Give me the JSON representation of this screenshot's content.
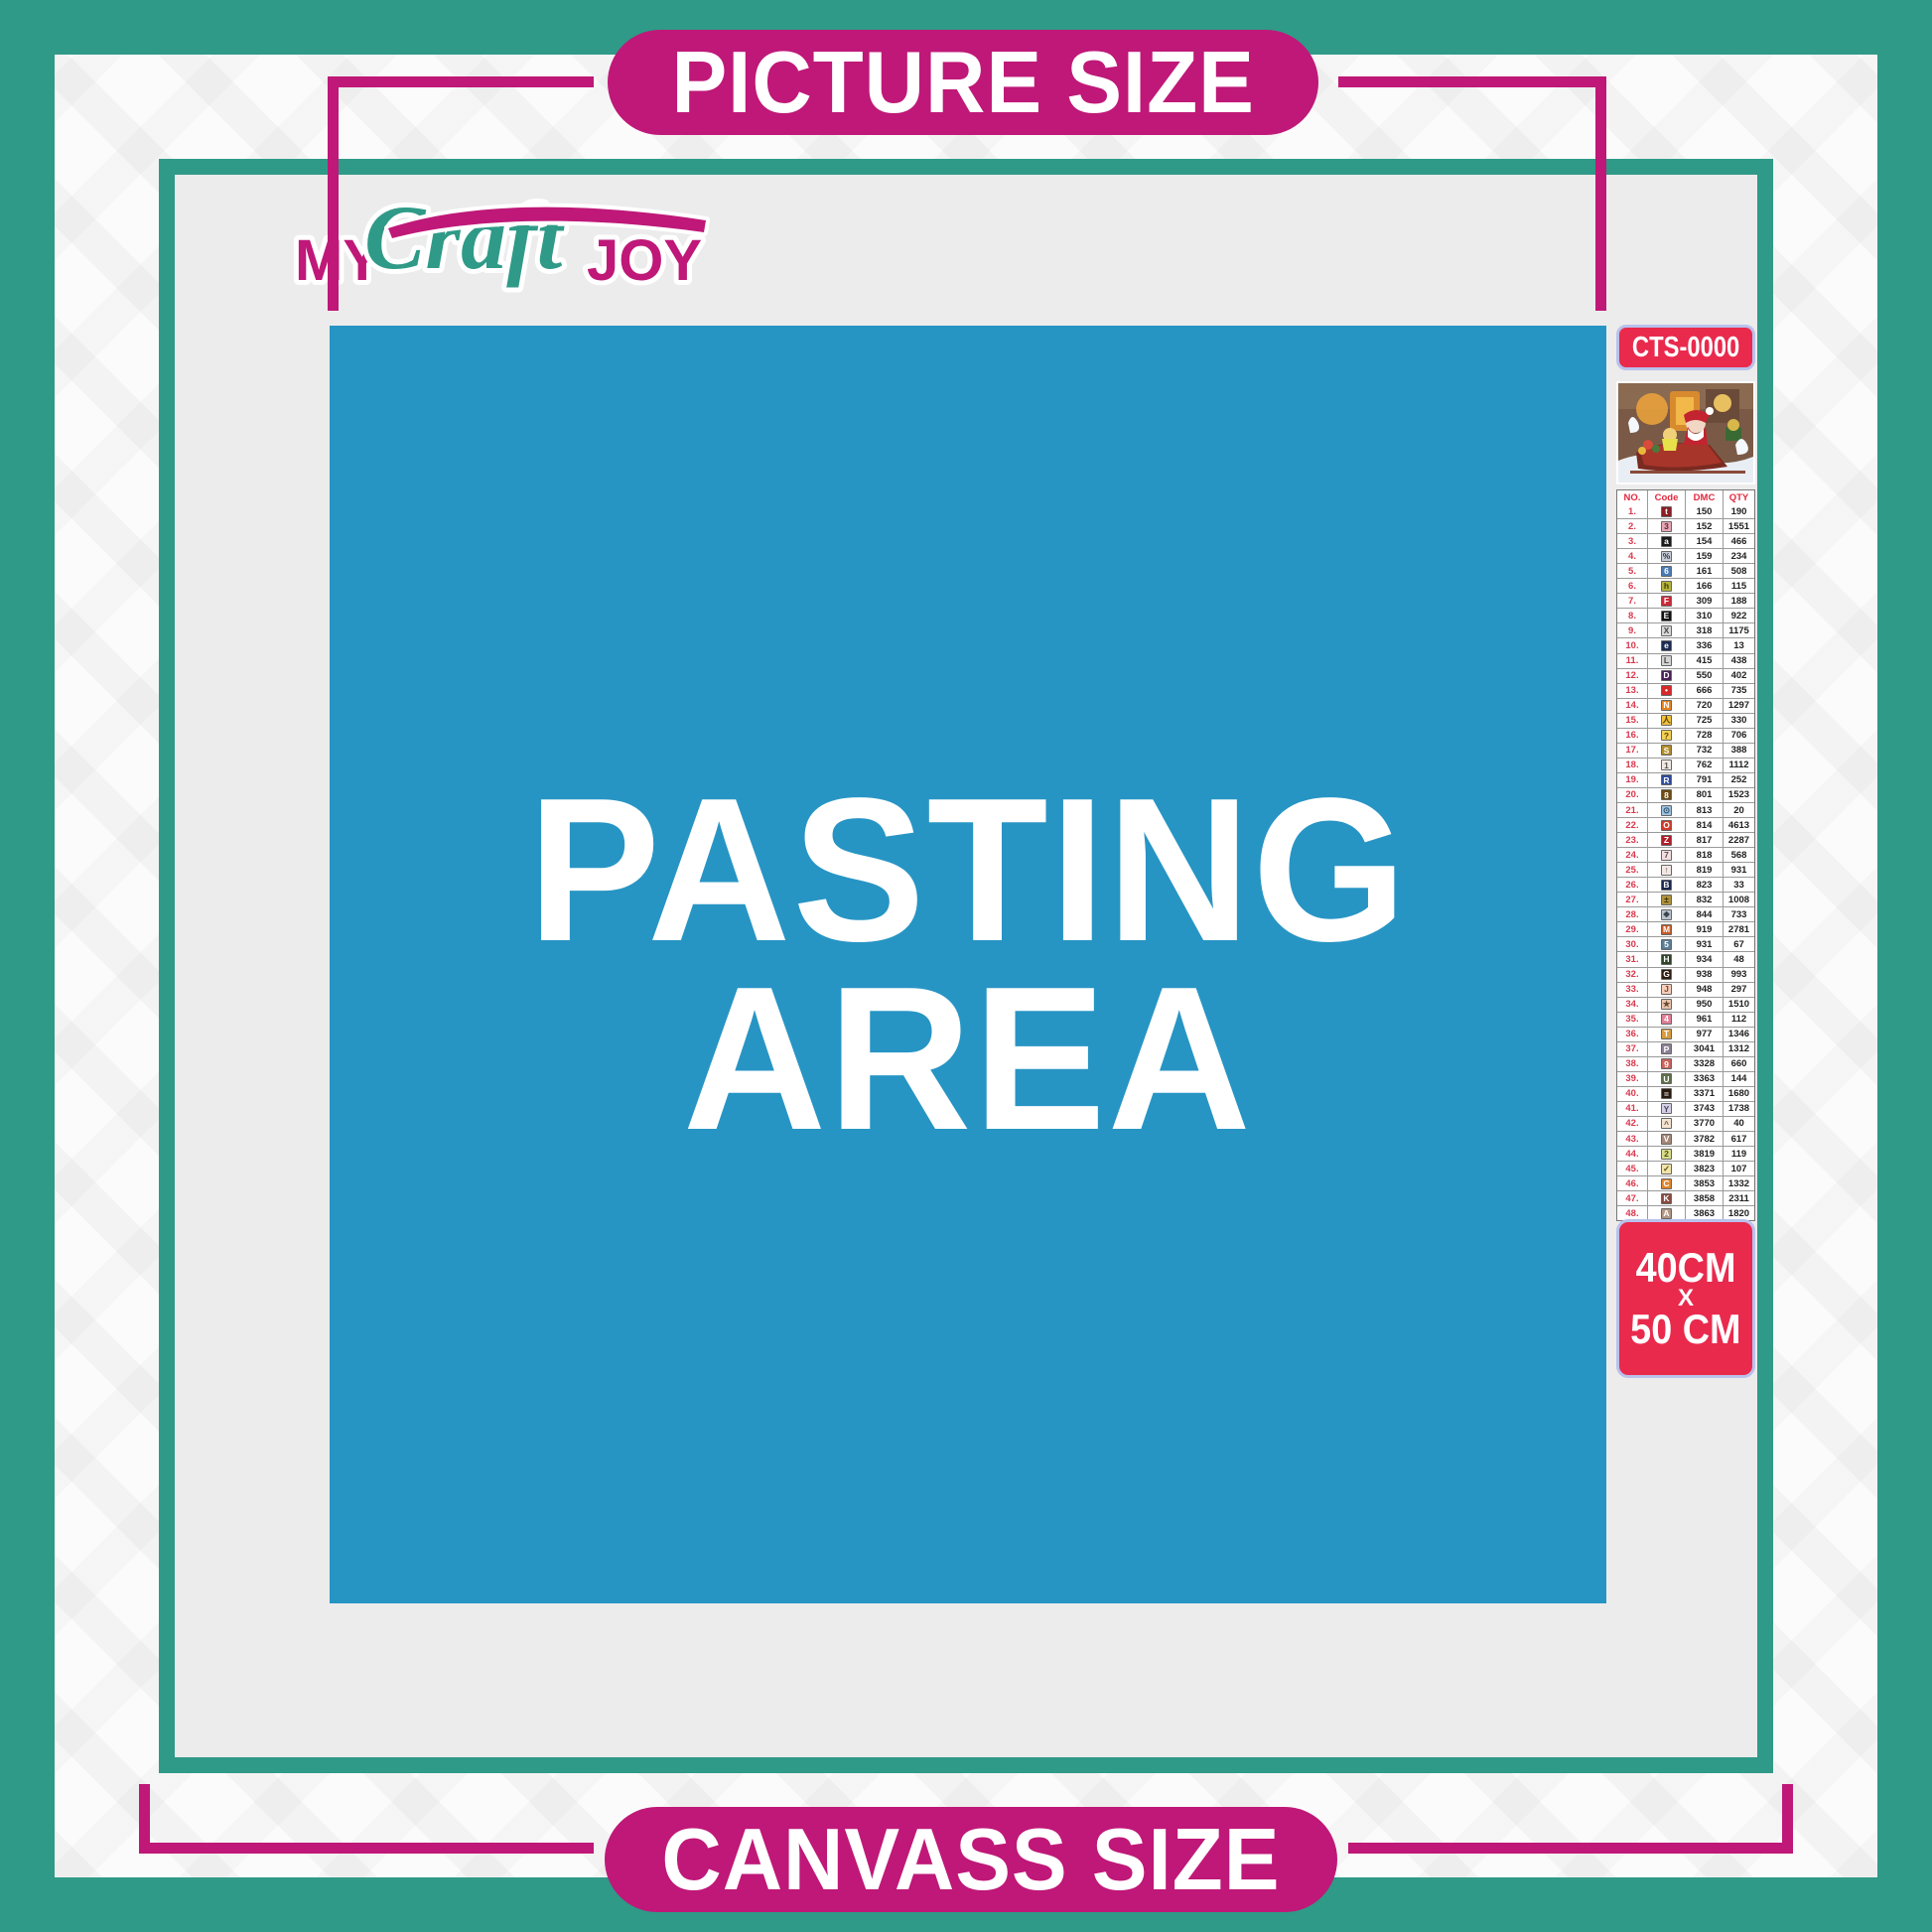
{
  "brand": {
    "my": "MY",
    "craft": "Craft",
    "joy": "JOY"
  },
  "banners": {
    "top": "PICTURE SIZE",
    "bottom": "CANVASS SIZE"
  },
  "pasting_area": {
    "line1": "PASTING",
    "line2": "AREA"
  },
  "sidebar": {
    "sku": "CTS-0000",
    "preview_alt": "santa-sleigh-christmas-scene",
    "size": {
      "line1": "40CM",
      "line2": "X",
      "line3": "50 CM"
    },
    "table": {
      "headers": [
        "NO.",
        "Code",
        "DMC",
        "QTY"
      ],
      "rows": [
        {
          "no": "1.",
          "sym": "t",
          "bg": "#8b1f24",
          "fg": "#ffffff",
          "dmc": "150",
          "qty": "190"
        },
        {
          "no": "2.",
          "sym": "3",
          "bg": "#e8a7b4",
          "fg": "#5a2a33",
          "dmc": "152",
          "qty": "1551"
        },
        {
          "no": "3.",
          "sym": "a",
          "bg": "#1a1a1a",
          "fg": "#ffffff",
          "dmc": "154",
          "qty": "466"
        },
        {
          "no": "4.",
          "sym": "%",
          "bg": "#c5cdd8",
          "fg": "#333333",
          "dmc": "159",
          "qty": "234"
        },
        {
          "no": "5.",
          "sym": "6",
          "bg": "#4a7ab5",
          "fg": "#ffffff",
          "dmc": "161",
          "qty": "508"
        },
        {
          "no": "6.",
          "sym": "h",
          "bg": "#b5b23a",
          "fg": "#3a3a10",
          "dmc": "166",
          "qty": "115"
        },
        {
          "no": "7.",
          "sym": "F",
          "bg": "#c92a39",
          "fg": "#ffffff",
          "dmc": "309",
          "qty": "188"
        },
        {
          "no": "8.",
          "sym": "E",
          "bg": "#111111",
          "fg": "#ffffff",
          "dmc": "310",
          "qty": "922"
        },
        {
          "no": "9.",
          "sym": "X",
          "bg": "#d8d8d8",
          "fg": "#444444",
          "dmc": "318",
          "qty": "1175"
        },
        {
          "no": "10.",
          "sym": "e",
          "bg": "#1d2c52",
          "fg": "#ffffff",
          "dmc": "336",
          "qty": "13"
        },
        {
          "no": "11.",
          "sym": "L",
          "bg": "#d3d3d3",
          "fg": "#444444",
          "dmc": "415",
          "qty": "438"
        },
        {
          "no": "12.",
          "sym": "D",
          "bg": "#4a2057",
          "fg": "#ffffff",
          "dmc": "550",
          "qty": "402"
        },
        {
          "no": "13.",
          "sym": "•",
          "bg": "#d62828",
          "fg": "#ffffff",
          "dmc": "666",
          "qty": "735"
        },
        {
          "no": "14.",
          "sym": "N",
          "bg": "#e8861f",
          "fg": "#ffffff",
          "dmc": "720",
          "qty": "1297"
        },
        {
          "no": "15.",
          "sym": "人",
          "bg": "#f0c03c",
          "fg": "#5a4208",
          "dmc": "725",
          "qty": "330"
        },
        {
          "no": "16.",
          "sym": "?",
          "bg": "#f3cf53",
          "fg": "#5a4208",
          "dmc": "728",
          "qty": "706"
        },
        {
          "no": "17.",
          "sym": "S",
          "bg": "#b08c28",
          "fg": "#ffffff",
          "dmc": "732",
          "qty": "388"
        },
        {
          "no": "18.",
          "sym": "1",
          "bg": "#f3e9e2",
          "fg": "#555555",
          "dmc": "762",
          "qty": "1112"
        },
        {
          "no": "19.",
          "sym": "R",
          "bg": "#2d4b9b",
          "fg": "#ffffff",
          "dmc": "791",
          "qty": "252"
        },
        {
          "no": "20.",
          "sym": "8",
          "bg": "#6b4a12",
          "fg": "#ffffff",
          "dmc": "801",
          "qty": "1523"
        },
        {
          "no": "21.",
          "sym": "⊙",
          "bg": "#9cc3e0",
          "fg": "#2a4a66",
          "dmc": "813",
          "qty": "20"
        },
        {
          "no": "22.",
          "sym": "O",
          "bg": "#cf3a2a",
          "fg": "#ffffff",
          "dmc": "814",
          "qty": "4613"
        },
        {
          "no": "23.",
          "sym": "Z",
          "bg": "#b01e28",
          "fg": "#ffffff",
          "dmc": "817",
          "qty": "2287"
        },
        {
          "no": "24.",
          "sym": "7",
          "bg": "#f6dde0",
          "fg": "#555555",
          "dmc": "818",
          "qty": "568"
        },
        {
          "no": "25.",
          "sym": "↑",
          "bg": "#f4e8e4",
          "fg": "#555555",
          "dmc": "819",
          "qty": "931"
        },
        {
          "no": "26.",
          "sym": "B",
          "bg": "#17264d",
          "fg": "#ffffff",
          "dmc": "823",
          "qty": "33"
        },
        {
          "no": "27.",
          "sym": "±",
          "bg": "#ad913c",
          "fg": "#3a2e08",
          "dmc": "832",
          "qty": "1008"
        },
        {
          "no": "28.",
          "sym": "❖",
          "bg": "#b9c3cc",
          "fg": "#3a444e",
          "dmc": "844",
          "qty": "733"
        },
        {
          "no": "29.",
          "sym": "M",
          "bg": "#c35a28",
          "fg": "#ffffff",
          "dmc": "919",
          "qty": "2781"
        },
        {
          "no": "30.",
          "sym": "5",
          "bg": "#5b7e96",
          "fg": "#ffffff",
          "dmc": "931",
          "qty": "67"
        },
        {
          "no": "31.",
          "sym": "H",
          "bg": "#2f4428",
          "fg": "#ffffff",
          "dmc": "934",
          "qty": "48"
        },
        {
          "no": "32.",
          "sym": "G",
          "bg": "#2e1d12",
          "fg": "#ffffff",
          "dmc": "938",
          "qty": "993"
        },
        {
          "no": "33.",
          "sym": "J",
          "bg": "#f5cdb8",
          "fg": "#7a4a30",
          "dmc": "948",
          "qty": "297"
        },
        {
          "no": "34.",
          "sym": "★",
          "bg": "#e7c3ac",
          "fg": "#6a4a34",
          "dmc": "950",
          "qty": "1510"
        },
        {
          "no": "35.",
          "sym": "4",
          "bg": "#e07f96",
          "fg": "#ffffff",
          "dmc": "961",
          "qty": "112"
        },
        {
          "no": "36.",
          "sym": "T",
          "bg": "#d89b3f",
          "fg": "#ffffff",
          "dmc": "977",
          "qty": "1346"
        },
        {
          "no": "37.",
          "sym": "P",
          "bg": "#8d8096",
          "fg": "#ffffff",
          "dmc": "3041",
          "qty": "1312"
        },
        {
          "no": "38.",
          "sym": "9",
          "bg": "#c9645c",
          "fg": "#ffffff",
          "dmc": "3328",
          "qty": "660"
        },
        {
          "no": "39.",
          "sym": "U",
          "bg": "#5e7049",
          "fg": "#ffffff",
          "dmc": "3363",
          "qty": "144"
        },
        {
          "no": "40.",
          "sym": "=",
          "bg": "#2a1b10",
          "fg": "#ffffff",
          "dmc": "3371",
          "qty": "1680"
        },
        {
          "no": "41.",
          "sym": "Y",
          "bg": "#d5cee4",
          "fg": "#4a4460",
          "dmc": "3743",
          "qty": "1738"
        },
        {
          "no": "42.",
          "sym": "^",
          "bg": "#f4e3cf",
          "fg": "#6a5a44",
          "dmc": "3770",
          "qty": "40"
        },
        {
          "no": "43.",
          "sym": "V",
          "bg": "#a48778",
          "fg": "#ffffff",
          "dmc": "3782",
          "qty": "617"
        },
        {
          "no": "44.",
          "sym": "2",
          "bg": "#d9dc8a",
          "fg": "#4a4e10",
          "dmc": "3819",
          "qty": "119"
        },
        {
          "no": "45.",
          "sym": "✓",
          "bg": "#f2e3a7",
          "fg": "#5a5020",
          "dmc": "3823",
          "qty": "107"
        },
        {
          "no": "46.",
          "sym": "C",
          "bg": "#e0862e",
          "fg": "#ffffff",
          "dmc": "3853",
          "qty": "1332"
        },
        {
          "no": "47.",
          "sym": "K",
          "bg": "#8a4a3e",
          "fg": "#ffffff",
          "dmc": "3858",
          "qty": "2311"
        },
        {
          "no": "48.",
          "sym": "A",
          "bg": "#b39782",
          "fg": "#ffffff",
          "dmc": "3863",
          "qty": "1820"
        }
      ]
    }
  },
  "colors": {
    "teal": "#2f9a87",
    "magenta": "#bf1878",
    "blue": "#2795c4",
    "canvas-gray": "#ececec",
    "band-white": "#fbfbfb",
    "badge-red": "#e92a4d",
    "badge-border": "#b9c1ec",
    "table-red": "#e3273d"
  }
}
